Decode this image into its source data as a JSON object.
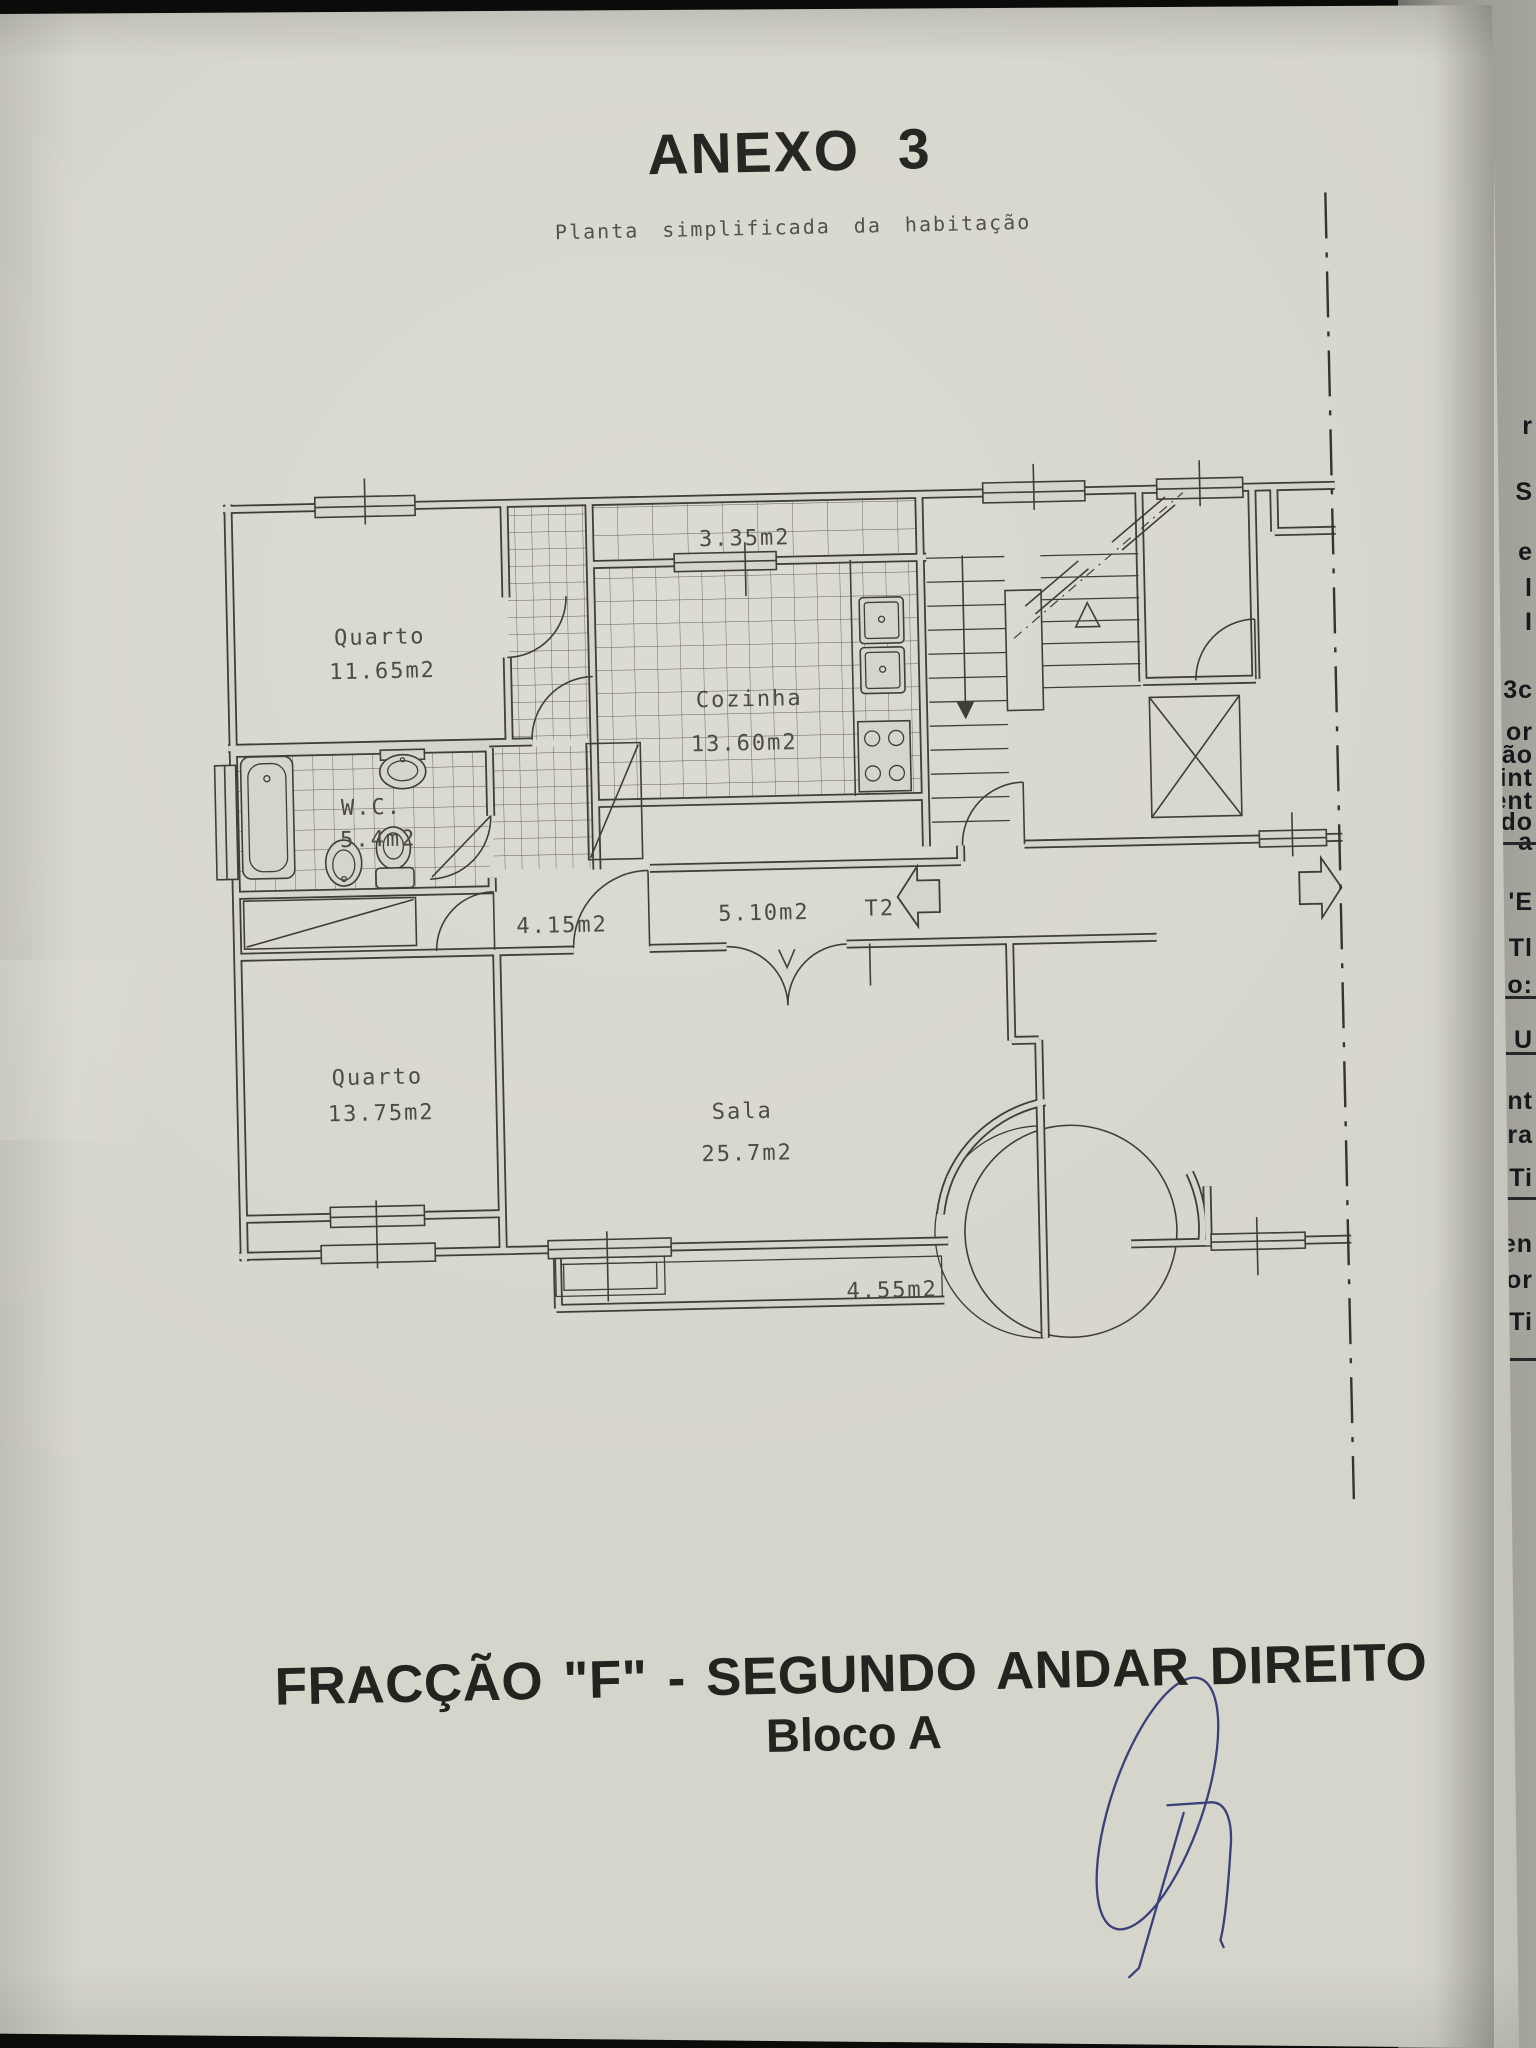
{
  "page": {
    "title": "ANEXO 3",
    "subtitle": "Planta simplificada da habitação",
    "footer_line1": "FRACÇÃO \"F\" - SEGUNDO ANDAR DIREITO",
    "footer_line2": "Bloco A"
  },
  "plan": {
    "tipologia": "T2",
    "rooms": {
      "quarto1": {
        "name": "Quarto",
        "area": "11.65m2"
      },
      "marquise": {
        "area": "3.35m2"
      },
      "cozinha": {
        "name": "Cozinha",
        "area": "13.60m2"
      },
      "wc": {
        "name": "W.C.",
        "area": "5.4m2"
      },
      "hall": {
        "area": "4.15m2"
      },
      "corredor": {
        "area": "5.10m2"
      },
      "quarto2": {
        "name": "Quarto",
        "area": "13.75m2"
      },
      "sala": {
        "name": "Sala",
        "area": "25.7m2"
      },
      "varanda": {
        "area": "4.55m2"
      }
    }
  },
  "underpage": {
    "fragments": [
      {
        "y": 412,
        "t": "r"
      },
      {
        "y": 478,
        "t": "S"
      },
      {
        "y": 538,
        "t": "e"
      },
      {
        "y": 574,
        "t": "l"
      },
      {
        "y": 608,
        "t": "I"
      },
      {
        "y": 676,
        "t": "3c"
      },
      {
        "y": 718,
        "t": "or"
      },
      {
        "y": 741,
        "t": "ão"
      },
      {
        "y": 764,
        "t": "int"
      },
      {
        "y": 787,
        "t": "ent"
      },
      {
        "y": 808,
        "t": "do"
      },
      {
        "y": 828,
        "t": "a"
      },
      {
        "y": 888,
        "t": "'E"
      },
      {
        "y": 934,
        "t": "Tl"
      },
      {
        "y": 971,
        "t": "o:"
      },
      {
        "y": 1026,
        "t": "U"
      },
      {
        "y": 1087,
        "t": "nt"
      },
      {
        "y": 1121,
        "t": "ora"
      },
      {
        "y": 1164,
        "t": "Ti"
      },
      {
        "y": 1230,
        "t": "len"
      },
      {
        "y": 1266,
        "t": "or"
      },
      {
        "y": 1308,
        "t": "Ti"
      }
    ],
    "rules": [
      842,
      996,
      1052,
      1197,
      1358
    ]
  },
  "colors": {
    "paper": "#d6d5cb",
    "ink": "#3f3e38",
    "signature": "#39407a",
    "underpage": "#9b9a92"
  }
}
